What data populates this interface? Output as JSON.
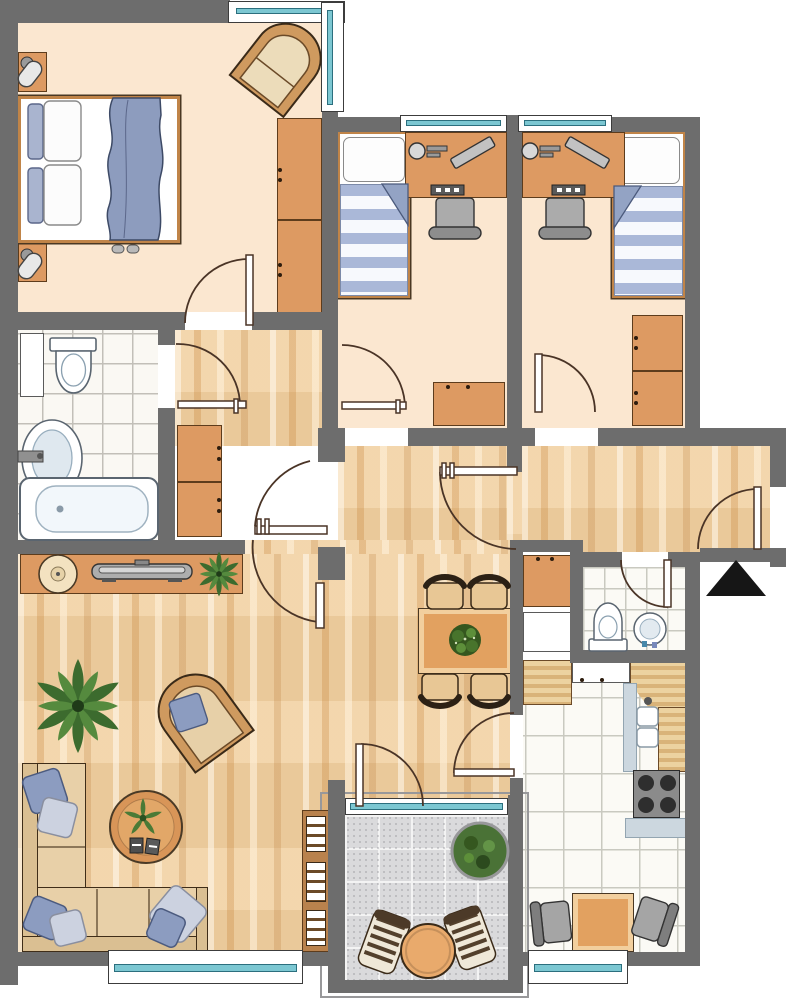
{
  "plan": {
    "kind": "apartment-floor-plan",
    "colors": {
      "wall": "#6d6d6d",
      "bedroom-floor": "#fbe7d0",
      "wood-floor": "#f2d2a4",
      "glass": "#7cc7d2",
      "orange": "#dd9a62",
      "table-orange": "#e2a160",
      "sofa": "#e8d0a8",
      "pillow-blue": "#8c9cc0",
      "pillow-light": "#ccd2e0",
      "plant-dark": "#3c6b2e",
      "plant-light": "#558a3e",
      "tile-bg": "#faf8f3",
      "tile-line": "#c2bfb8",
      "balcony-tile": "#dadadc",
      "counter-blue": "#ccd7df",
      "entrance-arrow": "#161616"
    },
    "icons": {
      "entrance_marker": "up-arrow-triangle"
    },
    "rooms": [
      {
        "id": "bedroom-master",
        "furniture": [
          "double-bed",
          "pillows",
          "blanket",
          "nightstand-left",
          "nightstand-right",
          "bedside-lamps",
          "wardrobe",
          "armchair",
          "slippers"
        ],
        "windows": [
          "corner-window-top",
          "corner-window-right"
        ]
      },
      {
        "id": "bedroom-child-1",
        "furniture": [
          "single-bed",
          "striped-duvet",
          "desk",
          "desk-lamp",
          "monitor",
          "keyboard",
          "desk-chair",
          "cabinet"
        ],
        "windows": [
          "top-window"
        ]
      },
      {
        "id": "bedroom-child-2",
        "furniture": [
          "single-bed",
          "striped-duvet",
          "desk",
          "desk-lamp",
          "monitor",
          "keyboard",
          "desk-chair",
          "wardrobe"
        ],
        "windows": [
          "top-window"
        ]
      },
      {
        "id": "bathroom",
        "furniture": [
          "bathtub",
          "washbasin",
          "toilet",
          "tall-cabinet"
        ]
      },
      {
        "id": "hallway",
        "furniture": [
          "wardrobe-cabinets"
        ]
      },
      {
        "id": "wc",
        "furniture": [
          "toilet",
          "round-washbasin"
        ]
      },
      {
        "id": "utility-nook",
        "furniture": [
          "cabinet",
          "washing-machine"
        ]
      },
      {
        "id": "kitchen",
        "furniture": [
          "counter",
          "upper-counter",
          "corner-counter",
          "double-sink",
          "stove-4-burners",
          "worktop",
          "square-table",
          "two-chairs"
        ],
        "windows": [
          "bottom-window"
        ]
      },
      {
        "id": "living-dining",
        "furniture": [
          "corner-sofa",
          "sofa-pillows",
          "coffee-table",
          "armchair",
          "large-plant",
          "sideboard",
          "bowl",
          "tv",
          "sideboard-plant",
          "bookshelf",
          "dining-table",
          "table-plant",
          "four-chairs"
        ],
        "windows": [
          "bottom-window"
        ]
      },
      {
        "id": "balcony",
        "furniture": [
          "round-table",
          "two-slatted-chairs",
          "potted-bush"
        ],
        "windows": [
          "glass-door"
        ]
      },
      {
        "id": "entrance",
        "marker": "entrance-arrow"
      }
    ],
    "doors": [
      "master-bedroom-door",
      "bathroom-door",
      "child1-door",
      "child2-door",
      "living-room-double-door",
      "hall-passage-door",
      "kitchen-door",
      "balcony-door",
      "wc-door",
      "entrance-door"
    ]
  }
}
